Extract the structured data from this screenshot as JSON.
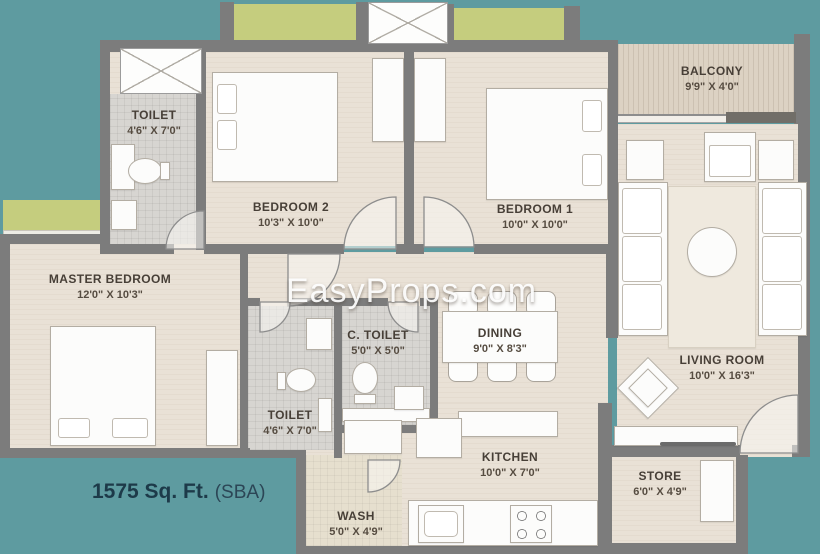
{
  "watermark": "EasyProps.com",
  "area": {
    "value": "1575 Sq. Ft.",
    "unit_note": "(SBA)"
  },
  "rooms": [
    {
      "id": "toilet-top",
      "name": "TOILET",
      "dims": "4'6\" X 7'0\""
    },
    {
      "id": "bedroom-2",
      "name": "BEDROOM 2",
      "dims": "10'3\" X 10'0\""
    },
    {
      "id": "bedroom-1",
      "name": "BEDROOM 1",
      "dims": "10'0\" X 10'0\""
    },
    {
      "id": "balcony",
      "name": "BALCONY",
      "dims": "9'9\" X 4'0\""
    },
    {
      "id": "master-bedroom",
      "name": "MASTER BEDROOM",
      "dims": "12'0\" X 10'3\""
    },
    {
      "id": "toilet-bottom",
      "name": "TOILET",
      "dims": "4'6\" X 7'0\""
    },
    {
      "id": "c-toilet",
      "name": "C. TOILET",
      "dims": "5'0\" X 5'0\""
    },
    {
      "id": "dining",
      "name": "DINING",
      "dims": "9'0\" X 8'3\""
    },
    {
      "id": "living-room",
      "name": "LIVING ROOM",
      "dims": "10'0\" X 16'3\""
    },
    {
      "id": "kitchen",
      "name": "KITCHEN",
      "dims": "10'0\" X 7'0\""
    },
    {
      "id": "store",
      "name": "STORE",
      "dims": "6'0\" X 4'9\""
    },
    {
      "id": "wash",
      "name": "WASH",
      "dims": "5'0\" X 4'9\""
    }
  ],
  "palette": {
    "background": "#5E9BA0",
    "wall": "#7C7C7C",
    "floor": "#E9E1D6",
    "toilet_tile": "#D7D5D1",
    "wash_tile": "#E6DFCE",
    "balcony_floor": "#DCD2C3",
    "ledge_green": "#C5CD7E",
    "furniture": "#FCFCFB",
    "room_label": "#473F37",
    "area_text": "#1D3A49",
    "watermark_text": "#FFFFFF"
  }
}
